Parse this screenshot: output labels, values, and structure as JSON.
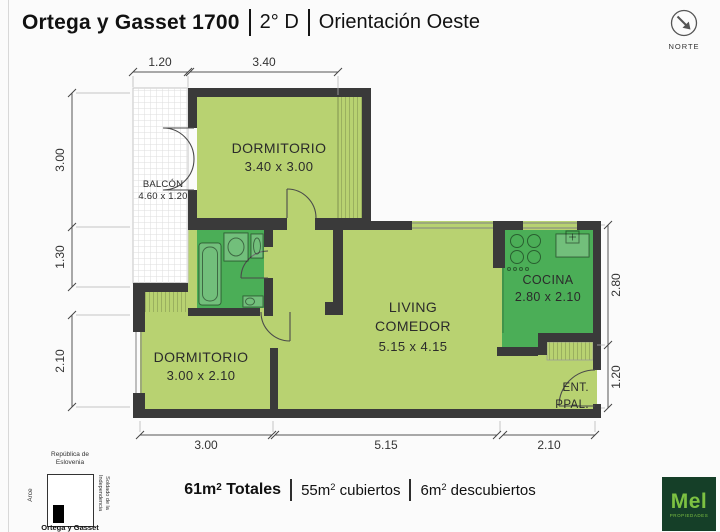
{
  "header": {
    "title": "Ortega y Gasset 1700",
    "unit": "2° D",
    "orientation": "Orientación Oeste"
  },
  "north": {
    "label": "NORTE"
  },
  "plan": {
    "rooms": {
      "dormitorio1": {
        "name": "DORMITORIO",
        "dims": "3.40 x 3.00"
      },
      "balcon": {
        "name": "BALCÓN",
        "dims": "4.60 x 1.20"
      },
      "dormitorio2": {
        "name": "DORMITORIO",
        "dims": "3.00 x 2.10"
      },
      "living": {
        "name1": "LIVING",
        "name2": "COMEDOR",
        "dims": "5.15 x 4.15"
      },
      "cocina": {
        "name": "COCINA",
        "dims": "2.80 x 2.10"
      },
      "entrada": {
        "line1": "ENT.",
        "line2": "PPAL."
      }
    },
    "dimensions": {
      "top": [
        "1.20",
        "3.40"
      ],
      "left": [
        "3.00",
        "1.30",
        "2.10"
      ],
      "right": [
        "2.80",
        "1.20"
      ],
      "bottom": [
        "3.00",
        "5.15",
        "2.10"
      ]
    },
    "colors": {
      "wall": "#3a3a3a",
      "room_light": "#b8d271",
      "room_dark": "#4bae57"
    }
  },
  "footer": {
    "totales": {
      "num": "61m",
      "sup": "2",
      "label": "Totales"
    },
    "cubiertos": {
      "num": "55m",
      "sup": "2",
      "label": "cubiertos"
    },
    "descubiertos": {
      "num": "6m",
      "sup": "2",
      "label": "descubiertos"
    }
  },
  "minimap": {
    "street_top_line1": "República de",
    "street_top_line2": "Eslovenia",
    "street_left": "Arce",
    "street_right_line1": "Soldado de la",
    "street_right_line2": "Independencia",
    "street_bottom": "Ortega y Gasset"
  },
  "logo": {
    "name": "Mel",
    "sub": "PROPIEDADES",
    "bg_color": "#153f28",
    "text_color": "#7cc142"
  }
}
